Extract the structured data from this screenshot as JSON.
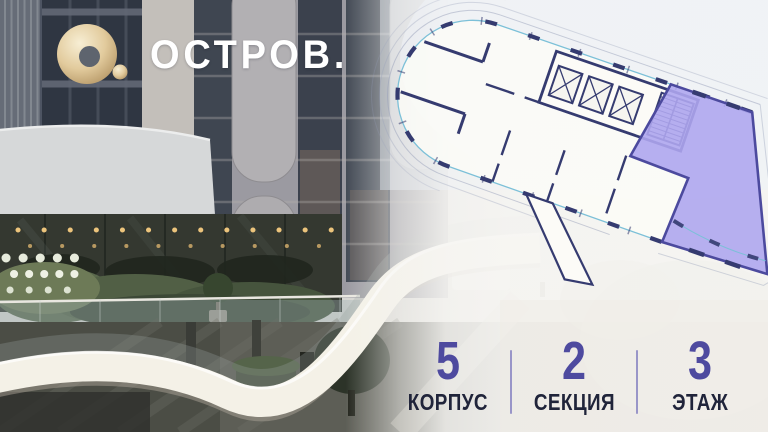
{
  "logo": {
    "text": "ОСТРОВ.",
    "mark_color": "#d9c191"
  },
  "floorplan": {
    "description": "tilted architectural floor plan with highlighted unit",
    "highlight_color": "#aea6ee",
    "highlight_border_color": "#4c4a9e",
    "wall_color": "#353b70",
    "facade_line_color": "#7cc0d8"
  },
  "stats": {
    "value_color": "#4e4a9f",
    "label_color": "#20243a",
    "items": [
      {
        "value": "5",
        "label": "КОРПУС"
      },
      {
        "value": "2",
        "label": "СЕКЦИЯ"
      },
      {
        "value": "3",
        "label": "ЭТАЖ"
      }
    ]
  }
}
